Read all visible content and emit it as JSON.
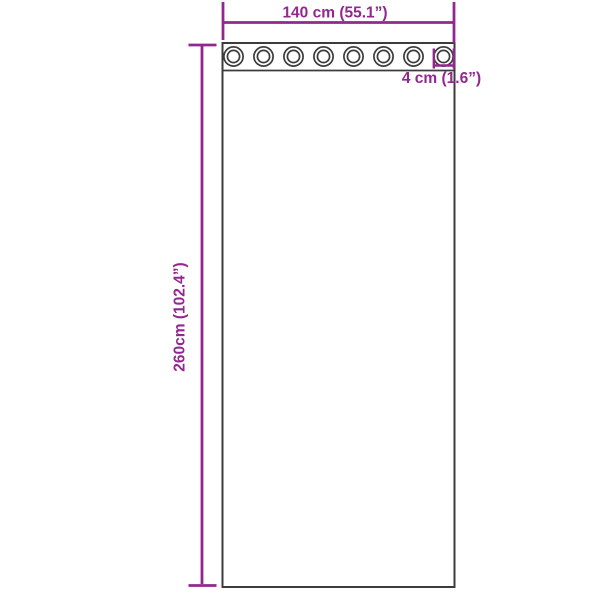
{
  "diagram": {
    "background_color": "#ffffff",
    "outline_color": "#3c3c3c",
    "dimension_color": "#92278f",
    "curtain": {
      "grommet_count": 8
    },
    "dimensions": {
      "width": {
        "label": "140 cm (55.1”)"
      },
      "height": {
        "label": "260cm (102.4”)"
      },
      "grommet_diameter": {
        "label": "4 cm (1.6”)"
      }
    }
  }
}
